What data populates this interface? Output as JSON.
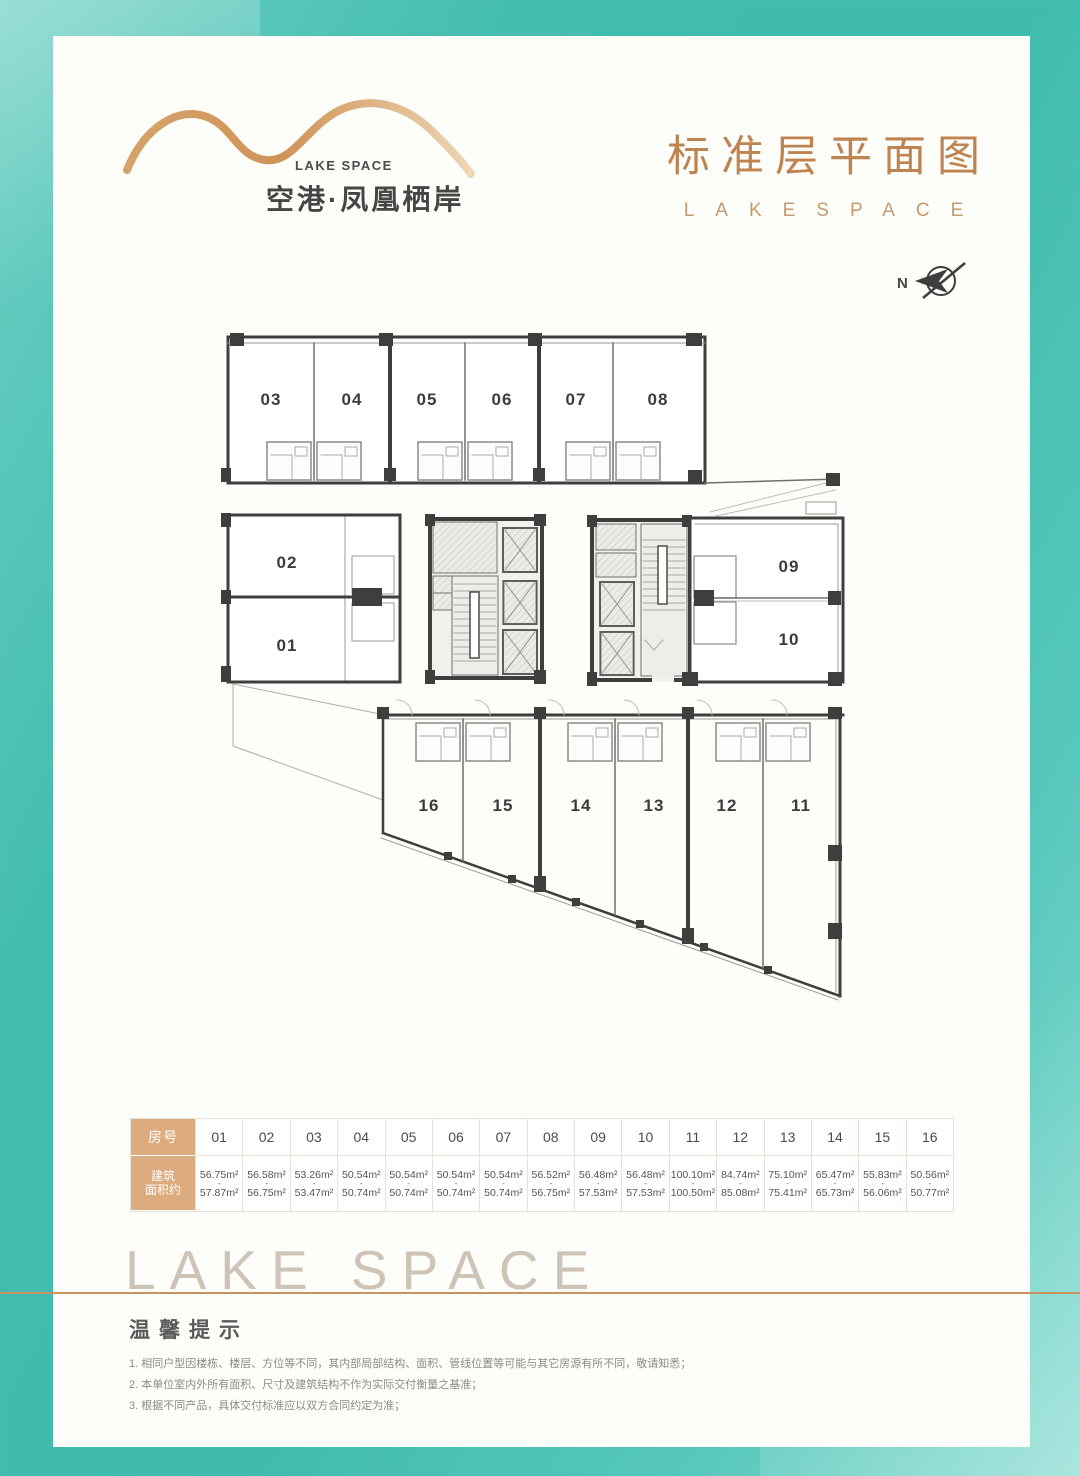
{
  "logo": {
    "brand_en": "LAKE SPACE",
    "brand_cn": "空港·凤凰栖岸"
  },
  "title": {
    "cn": "标准层平面图",
    "en": "LAKESPACE"
  },
  "plan": {
    "north_label": "N",
    "top_units": [
      "03",
      "04",
      "05",
      "06",
      "07",
      "08"
    ],
    "left_units": [
      "02",
      "01"
    ],
    "right_units": [
      "09",
      "10"
    ],
    "bottom_units": [
      "16",
      "15",
      "14",
      "13",
      "12",
      "11"
    ]
  },
  "table": {
    "room_header": "房号",
    "area_header_l1": "建筑",
    "area_header_l2": "面积约",
    "range_sep": "-",
    "columns": [
      {
        "room": "01",
        "min": "56.75m²",
        "max": "57.87m²"
      },
      {
        "room": "02",
        "min": "56.58m²",
        "max": "56.75m²"
      },
      {
        "room": "03",
        "min": "53.26m²",
        "max": "53.47m²"
      },
      {
        "room": "04",
        "min": "50.54m²",
        "max": "50.74m²"
      },
      {
        "room": "05",
        "min": "50.54m²",
        "max": "50.74m²"
      },
      {
        "room": "06",
        "min": "50.54m²",
        "max": "50.74m²"
      },
      {
        "room": "07",
        "min": "50.54m²",
        "max": "50.74m²"
      },
      {
        "room": "08",
        "min": "56.52m²",
        "max": "56.75m²"
      },
      {
        "room": "09",
        "min": "56.48m²",
        "max": "57.53m²"
      },
      {
        "room": "10",
        "min": "56.48m²",
        "max": "57.53m²"
      },
      {
        "room": "11",
        "min": "100.10m²",
        "max": "100.50m²"
      },
      {
        "room": "12",
        "min": "84.74m²",
        "max": "85.08m²"
      },
      {
        "room": "13",
        "min": "75.10m²",
        "max": "75.41m²"
      },
      {
        "room": "14",
        "min": "65.47m²",
        "max": "65.73m²"
      },
      {
        "room": "15",
        "min": "55.83m²",
        "max": "56.06m²"
      },
      {
        "room": "16",
        "min": "50.56m²",
        "max": "50.77m²"
      }
    ]
  },
  "footer": {
    "watermark": "LAKE SPACE",
    "tips_title": "温馨提示",
    "notes": [
      "1. 相同户型因楼栋、楼层、方位等不同，其内部局部结构、面积、管线位置等可能与其它房源有所不同，敬请知悉；",
      "2. 本单位室内外所有面积、尺寸及建筑结构不作为实际交付衡量之基准；",
      "3. 根据不同产品，具体交付标准应以双方合同约定为准；"
    ]
  }
}
